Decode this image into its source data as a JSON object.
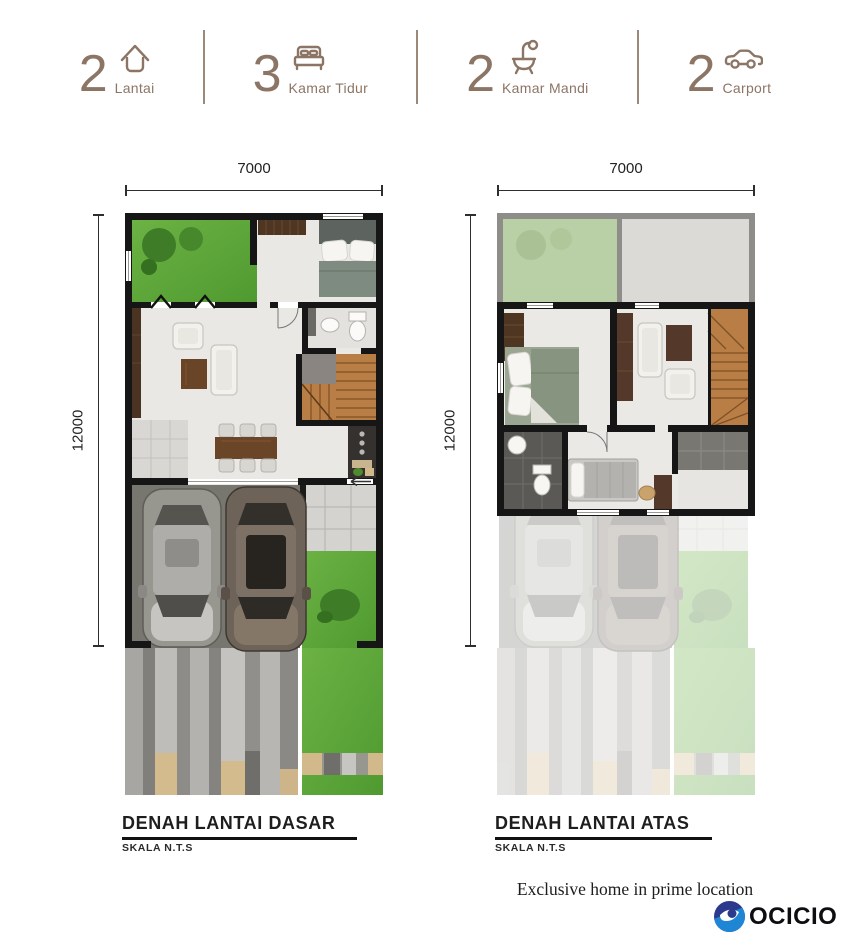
{
  "header": {
    "stats": [
      {
        "value": "2",
        "label": "Lantai",
        "icon": "house-icon"
      },
      {
        "value": "3",
        "label": "Kamar Tidur",
        "icon": "bed-icon"
      },
      {
        "value": "2",
        "label": "Kamar Mandi",
        "icon": "bath-icon"
      },
      {
        "value": "2",
        "label": "Carport",
        "icon": "car-icon"
      }
    ]
  },
  "plans": [
    {
      "title": "DENAH LANTAI DASAR",
      "scale_note": "SKALA N.T.S",
      "width_dim": "7000",
      "height_dim": "12000"
    },
    {
      "title": "DENAH LANTAI ATAS",
      "scale_note": "SKALA N.T.S",
      "width_dim": "7000",
      "height_dim": "12000"
    }
  ],
  "footer": {
    "tagline": "Exclusive home in prime location",
    "brand": "OCICIO"
  },
  "colors": {
    "accent_taupe": "#8c7565",
    "wall_black": "#161616",
    "grass_green": "#5aa335",
    "wood_brown": "#b97e45",
    "logo_light_blue": "#1f86d6",
    "logo_navy": "#2c3a8e"
  }
}
